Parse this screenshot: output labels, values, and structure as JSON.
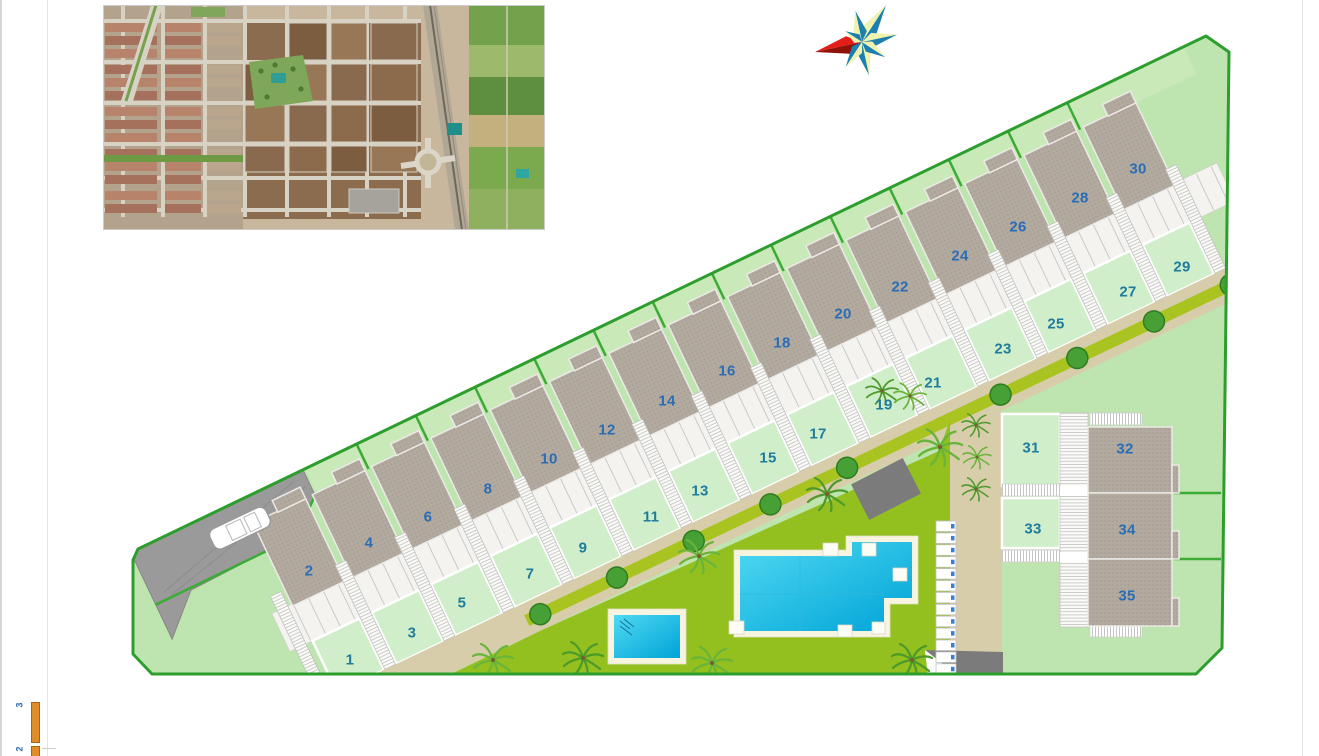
{
  "page": {
    "background": "#ffffff"
  },
  "colors": {
    "page_bg": "#ffffff",
    "site": "#bee5af",
    "garden": "#d0eec9",
    "backyard": "#c9e9b8",
    "roof_base": "#b2a99f",
    "roof_dot": "#a19890",
    "boundary": "#2d9e2d",
    "fence": "#3cab36",
    "lawn": "#93c01e",
    "path": "#d8cdab",
    "median": "#a9c421",
    "pool_water_light": "#4fd9f2",
    "pool_water_dark": "#00a3d7",
    "pool_border": "#f7f5e0",
    "driveway": "#9a9a9a",
    "structure": "#7b7b7b",
    "parking_mark": "#3a7fd6",
    "number_roof": "#2a6db5",
    "number_garden": "#1f7c9c",
    "scale_bar": "#e08c28",
    "compass_teal": "#1d7fae",
    "compass_pale": "#eef3ae",
    "compass_red": "#e31e18",
    "compass_darkred": "#8f1108"
  },
  "site_plan": {
    "plots": [
      {
        "label": "1",
        "surface": "garden",
        "x": 350,
        "y": 660
      },
      {
        "label": "2",
        "surface": "roof",
        "x": 309,
        "y": 571
      },
      {
        "label": "3",
        "surface": "garden",
        "x": 412,
        "y": 633
      },
      {
        "label": "4",
        "surface": "roof",
        "x": 369,
        "y": 543
      },
      {
        "label": "5",
        "surface": "garden",
        "x": 462,
        "y": 603
      },
      {
        "label": "6",
        "surface": "roof",
        "x": 428,
        "y": 517
      },
      {
        "label": "7",
        "surface": "garden",
        "x": 530,
        "y": 574
      },
      {
        "label": "8",
        "surface": "roof",
        "x": 488,
        "y": 489
      },
      {
        "label": "9",
        "surface": "garden",
        "x": 583,
        "y": 548
      },
      {
        "label": "10",
        "surface": "roof",
        "x": 549,
        "y": 459
      },
      {
        "label": "11",
        "surface": "garden",
        "x": 651,
        "y": 517
      },
      {
        "label": "12",
        "surface": "roof",
        "x": 607,
        "y": 430
      },
      {
        "label": "13",
        "surface": "garden",
        "x": 700,
        "y": 491
      },
      {
        "label": "14",
        "surface": "roof",
        "x": 667,
        "y": 401
      },
      {
        "label": "15",
        "surface": "garden",
        "x": 768,
        "y": 458
      },
      {
        "label": "16",
        "surface": "roof",
        "x": 727,
        "y": 371
      },
      {
        "label": "17",
        "surface": "garden",
        "x": 818,
        "y": 434
      },
      {
        "label": "18",
        "surface": "roof",
        "x": 782,
        "y": 343
      },
      {
        "label": "19",
        "surface": "garden",
        "x": 884,
        "y": 405
      },
      {
        "label": "20",
        "surface": "roof",
        "x": 843,
        "y": 314
      },
      {
        "label": "21",
        "surface": "garden",
        "x": 933,
        "y": 383
      },
      {
        "label": "22",
        "surface": "roof",
        "x": 900,
        "y": 287
      },
      {
        "label": "23",
        "surface": "garden",
        "x": 1003,
        "y": 349
      },
      {
        "label": "24",
        "surface": "roof",
        "x": 960,
        "y": 256
      },
      {
        "label": "25",
        "surface": "garden",
        "x": 1056,
        "y": 324
      },
      {
        "label": "26",
        "surface": "roof",
        "x": 1018,
        "y": 227
      },
      {
        "label": "27",
        "surface": "garden",
        "x": 1128,
        "y": 292
      },
      {
        "label": "28",
        "surface": "roof",
        "x": 1080,
        "y": 198
      },
      {
        "label": "29",
        "surface": "garden",
        "x": 1182,
        "y": 267
      },
      {
        "label": "30",
        "surface": "roof",
        "x": 1138,
        "y": 169
      },
      {
        "label": "31",
        "surface": "garden",
        "x": 1031,
        "y": 448
      },
      {
        "label": "32",
        "surface": "roof",
        "x": 1125,
        "y": 449
      },
      {
        "label": "33",
        "surface": "garden",
        "x": 1033,
        "y": 529
      },
      {
        "label": "34",
        "surface": "roof",
        "x": 1127,
        "y": 530
      },
      {
        "label": "35",
        "surface": "roof",
        "x": 1127,
        "y": 596
      }
    ],
    "icons": [
      "compass-rose-icon",
      "aerial-photo-inset",
      "car-icon",
      "palm-tree-icon",
      "round-tree-icon",
      "main-pool",
      "kids-pool",
      "pergola",
      "access-ramp",
      "parking-slots",
      "scale-bar"
    ]
  },
  "legend": {
    "items": [
      "3",
      "2"
    ]
  }
}
